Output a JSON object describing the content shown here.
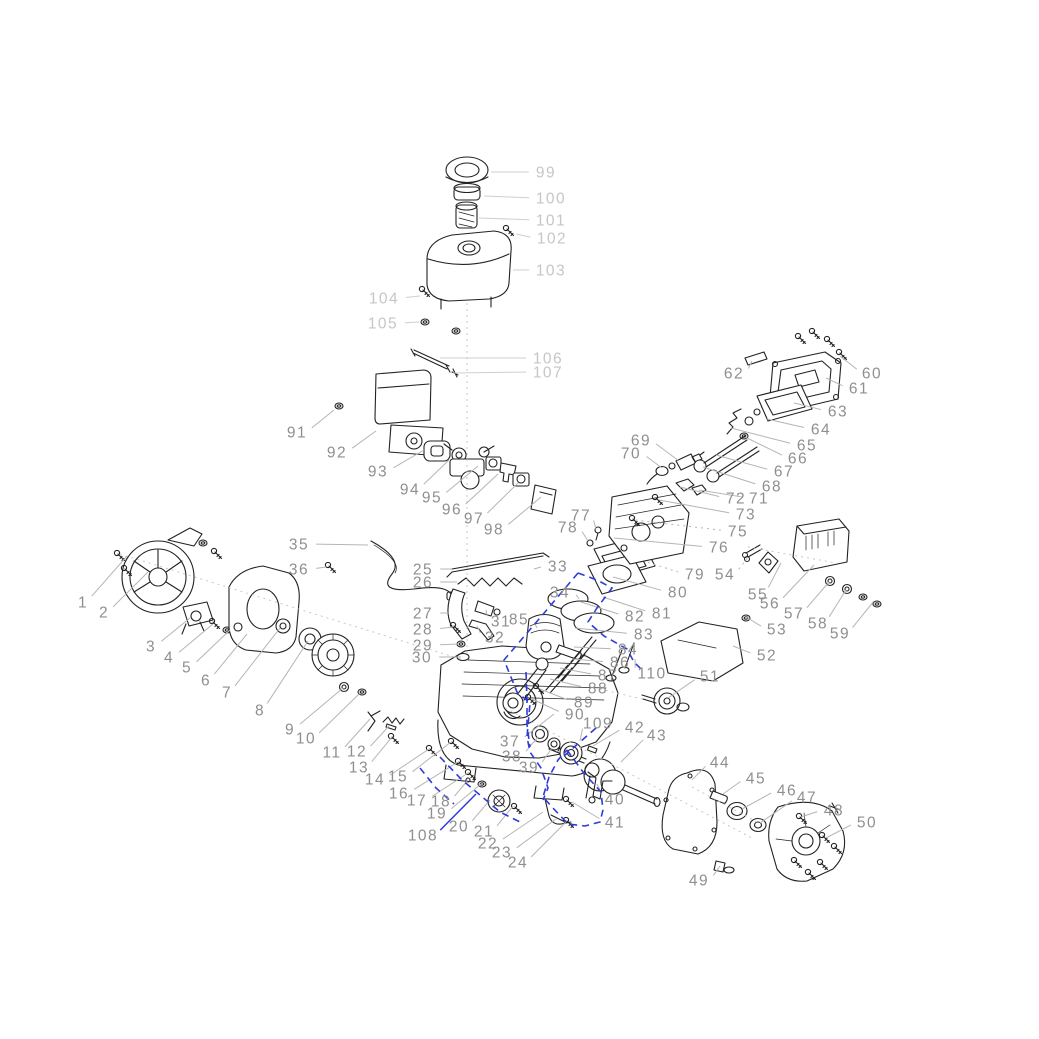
{
  "diagram": {
    "title": "engine-exploded-parts-diagram",
    "background": "#ffffff",
    "colors": {
      "ink": "#222222",
      "label_dark": "#8f8f8f",
      "label_light": "#c6c6c6",
      "leader_dark": "#b5b5b5",
      "leader_light": "#cfcfcf",
      "guide": "#c2c2c2",
      "highlight": "#2e3cd9"
    },
    "font_size": 15.5,
    "labels": [
      {
        "n": "1",
        "x": 83,
        "y": 602,
        "ex": 127,
        "ey": 556
      },
      {
        "n": "2",
        "x": 104,
        "y": 612,
        "ex": 148,
        "ey": 572
      },
      {
        "n": "3",
        "x": 151,
        "y": 646,
        "ex": 190,
        "ey": 618
      },
      {
        "n": "4",
        "x": 169,
        "y": 657,
        "ex": 213,
        "ey": 624
      },
      {
        "n": "5",
        "x": 187,
        "y": 667,
        "ex": 230,
        "ey": 630
      },
      {
        "n": "6",
        "x": 206,
        "y": 680,
        "ex": 247,
        "ey": 634
      },
      {
        "n": "7",
        "x": 227,
        "y": 692,
        "ex": 280,
        "ey": 628
      },
      {
        "n": "8",
        "x": 260,
        "y": 710,
        "ex": 308,
        "ey": 641
      },
      {
        "n": "9",
        "x": 290,
        "y": 729,
        "ex": 343,
        "ey": 688
      },
      {
        "n": "10",
        "x": 306,
        "y": 738,
        "ex": 360,
        "ey": 693
      },
      {
        "n": "11",
        "x": 332,
        "y": 752,
        "ex": 370,
        "ey": 719
      },
      {
        "n": "12",
        "x": 357,
        "y": 751,
        "ex": 389,
        "ey": 726
      },
      {
        "n": "13",
        "x": 359,
        "y": 767,
        "ex": 392,
        "ey": 737
      },
      {
        "n": "14",
        "x": 375,
        "y": 779,
        "ex": 429,
        "ey": 749
      },
      {
        "n": "15",
        "x": 398,
        "y": 776,
        "ex": 451,
        "ey": 742
      },
      {
        "n": "16",
        "x": 399,
        "y": 793,
        "ex": 458,
        "ey": 762
      },
      {
        "n": "17",
        "x": 417,
        "y": 800,
        "ex": 468,
        "ey": 773
      },
      {
        "n": "18",
        "x": 441,
        "y": 801,
        "ex": 468,
        "ey": 780
      },
      {
        "n": "19",
        "x": 437,
        "y": 813,
        "ex": 481,
        "ey": 784
      },
      {
        "n": "20",
        "x": 459,
        "y": 826,
        "ex": 490,
        "ey": 800
      },
      {
        "n": "21",
        "x": 484,
        "y": 831,
        "ex": 513,
        "ey": 806
      },
      {
        "n": "22",
        "x": 488,
        "y": 843,
        "ex": 543,
        "ey": 812
      },
      {
        "n": "23",
        "x": 502,
        "y": 852,
        "ex": 556,
        "ey": 819
      },
      {
        "n": "24",
        "x": 518,
        "y": 862,
        "ex": 566,
        "ey": 822
      },
      {
        "n": "25",
        "x": 423,
        "y": 569,
        "ex": 451,
        "ey": 569
      },
      {
        "n": "26",
        "x": 423,
        "y": 582,
        "ex": 457,
        "ey": 582
      },
      {
        "n": "27",
        "x": 423,
        "y": 613,
        "ex": 449,
        "ey": 613
      },
      {
        "n": "28",
        "x": 423,
        "y": 629,
        "ex": 453,
        "ey": 627
      },
      {
        "n": "29",
        "x": 423,
        "y": 645,
        "ex": 459,
        "ey": 644
      },
      {
        "n": "30",
        "x": 422,
        "y": 657,
        "ex": 461,
        "ey": 657
      },
      {
        "n": "31",
        "x": 501,
        "y": 621,
        "ex": 486,
        "ey": 610
      },
      {
        "n": "32",
        "x": 495,
        "y": 637,
        "ex": 477,
        "ey": 626
      },
      {
        "n": "33",
        "x": 558,
        "y": 566,
        "ex": 534,
        "ey": 569
      },
      {
        "n": "34",
        "x": 560,
        "y": 592,
        "ex": 579,
        "ey": 599
      },
      {
        "n": "35",
        "x": 299,
        "y": 544,
        "ex": 368,
        "ey": 545
      },
      {
        "n": "36",
        "x": 299,
        "y": 569,
        "ex": 326,
        "ey": 567
      },
      {
        "n": "37",
        "x": 510,
        "y": 741,
        "ex": 554,
        "ey": 714
      },
      {
        "n": "38",
        "x": 512,
        "y": 756,
        "ex": 538,
        "ey": 737
      },
      {
        "n": "39",
        "x": 529,
        "y": 767,
        "ex": 552,
        "ey": 748
      },
      {
        "n": "40",
        "x": 615,
        "y": 799,
        "ex": 597,
        "ey": 784
      },
      {
        "n": "41",
        "x": 615,
        "y": 822,
        "ex": 572,
        "ey": 802
      },
      {
        "n": "42",
        "x": 635,
        "y": 727,
        "ex": 593,
        "ey": 746
      },
      {
        "n": "43",
        "x": 657,
        "y": 735,
        "ex": 621,
        "ey": 762
      },
      {
        "n": "44",
        "x": 720,
        "y": 762,
        "ex": 692,
        "ey": 780
      },
      {
        "n": "45",
        "x": 756,
        "y": 778,
        "ex": 723,
        "ey": 794
      },
      {
        "n": "46",
        "x": 787,
        "y": 790,
        "ex": 742,
        "ey": 809
      },
      {
        "n": "47",
        "x": 807,
        "y": 797,
        "ex": 760,
        "ey": 823
      },
      {
        "n": "48",
        "x": 834,
        "y": 810,
        "ex": 801,
        "ey": 817
      },
      {
        "n": "49",
        "x": 699,
        "y": 880,
        "ex": 720,
        "ey": 866
      },
      {
        "n": "50",
        "x": 867,
        "y": 822,
        "ex": 826,
        "ey": 838
      },
      {
        "n": "51",
        "x": 710,
        "y": 676,
        "ex": 668,
        "ey": 698
      },
      {
        "n": "52",
        "x": 767,
        "y": 655,
        "ex": 733,
        "ey": 646
      },
      {
        "n": "53",
        "x": 777,
        "y": 629,
        "ex": 746,
        "ey": 617
      },
      {
        "n": "54",
        "x": 725,
        "y": 574,
        "ex": 749,
        "ey": 556,
        "d": 1
      },
      {
        "n": "55",
        "x": 758,
        "y": 594,
        "ex": 781,
        "ey": 563
      },
      {
        "n": "56",
        "x": 770,
        "y": 603,
        "ex": 814,
        "ey": 565
      },
      {
        "n": "57",
        "x": 794,
        "y": 613,
        "ex": 829,
        "ey": 582
      },
      {
        "n": "58",
        "x": 818,
        "y": 623,
        "ex": 846,
        "ey": 590
      },
      {
        "n": "59",
        "x": 840,
        "y": 633,
        "ex": 874,
        "ey": 601
      },
      {
        "n": "60",
        "x": 872,
        "y": 373,
        "ex": 840,
        "ey": 356
      },
      {
        "n": "61",
        "x": 859,
        "y": 388,
        "ex": 826,
        "ey": 378
      },
      {
        "n": "62",
        "x": 734,
        "y": 373,
        "ex": 752,
        "ey": 361
      },
      {
        "n": "63",
        "x": 838,
        "y": 411,
        "ex": 794,
        "ey": 403
      },
      {
        "n": "64",
        "x": 821,
        "y": 429,
        "ex": 767,
        "ey": 419
      },
      {
        "n": "65",
        "x": 807,
        "y": 445,
        "ex": 731,
        "ey": 428
      },
      {
        "n": "66",
        "x": 798,
        "y": 458,
        "ex": 745,
        "ey": 437
      },
      {
        "n": "67",
        "x": 784,
        "y": 471,
        "ex": 716,
        "ey": 455
      },
      {
        "n": "68",
        "x": 772,
        "y": 486,
        "ex": 703,
        "ey": 467
      },
      {
        "n": "69",
        "x": 641,
        "y": 440,
        "ex": 679,
        "ey": 461
      },
      {
        "n": "70",
        "x": 631,
        "y": 453,
        "ex": 662,
        "ey": 468
      },
      {
        "n": "71",
        "x": 759,
        "y": 498,
        "ex": 699,
        "ey": 490
      },
      {
        "n": "72",
        "x": 736,
        "y": 498,
        "ex": 680,
        "ey": 487
      },
      {
        "n": "73",
        "x": 746,
        "y": 514,
        "ex": 659,
        "ey": 500
      },
      {
        "n": "75",
        "x": 738,
        "y": 531,
        "ex": 635,
        "ey": 520,
        "d": 1
      },
      {
        "n": "76",
        "x": 719,
        "y": 547,
        "ex": 614,
        "ey": 538
      },
      {
        "n": "77",
        "x": 581,
        "y": 515,
        "ex": 596,
        "ey": 529
      },
      {
        "n": "78",
        "x": 568,
        "y": 527,
        "ex": 588,
        "ey": 541
      },
      {
        "n": "79",
        "x": 695,
        "y": 574,
        "ex": 647,
        "ey": 562,
        "d": 1
      },
      {
        "n": "80",
        "x": 678,
        "y": 592,
        "ex": 613,
        "ey": 577
      },
      {
        "n": "81",
        "x": 662,
        "y": 613,
        "ex": 603,
        "ey": 597
      },
      {
        "n": "82",
        "x": 635,
        "y": 616,
        "ex": 581,
        "ey": 602
      },
      {
        "n": "83",
        "x": 644,
        "y": 634,
        "ex": 575,
        "ey": 628
      },
      {
        "n": "84",
        "x": 628,
        "y": 649,
        "ex": 574,
        "ey": 647
      },
      {
        "n": "85",
        "x": 519,
        "y": 619,
        "ex": 537,
        "ey": 628
      },
      {
        "n": "86",
        "x": 620,
        "y": 662,
        "ex": 572,
        "ey": 659
      },
      {
        "n": "87",
        "x": 608,
        "y": 675,
        "ex": 560,
        "ey": 668
      },
      {
        "n": "88",
        "x": 598,
        "y": 688,
        "ex": 550,
        "ey": 679
      },
      {
        "n": "89",
        "x": 584,
        "y": 702,
        "ex": 540,
        "ey": 689
      },
      {
        "n": "90",
        "x": 575,
        "y": 714,
        "ex": 532,
        "ey": 699
      },
      {
        "n": "91",
        "x": 297,
        "y": 432,
        "ex": 334,
        "ey": 410
      },
      {
        "n": "92",
        "x": 337,
        "y": 452,
        "ex": 376,
        "ey": 431
      },
      {
        "n": "93",
        "x": 378,
        "y": 471,
        "ex": 424,
        "ey": 450
      },
      {
        "n": "94",
        "x": 410,
        "y": 489,
        "ex": 449,
        "ey": 460
      },
      {
        "n": "95",
        "x": 432,
        "y": 497,
        "ex": 478,
        "ey": 466
      },
      {
        "n": "96",
        "x": 452,
        "y": 509,
        "ex": 498,
        "ey": 474
      },
      {
        "n": "97",
        "x": 474,
        "y": 518,
        "ex": 518,
        "ey": 483
      },
      {
        "n": "98",
        "x": 494,
        "y": 529,
        "ex": 541,
        "ey": 497
      },
      {
        "n": "99",
        "x": 546,
        "y": 172,
        "ex": 491,
        "ey": 172,
        "s": "l"
      },
      {
        "n": "100",
        "x": 551,
        "y": 198,
        "ex": 484,
        "ey": 196,
        "s": "l"
      },
      {
        "n": "101",
        "x": 551,
        "y": 220,
        "ex": 479,
        "ey": 218,
        "s": "l"
      },
      {
        "n": "102",
        "x": 552,
        "y": 238,
        "ex": 516,
        "ey": 234,
        "s": "l"
      },
      {
        "n": "103",
        "x": 551,
        "y": 270,
        "ex": 513,
        "ey": 270,
        "s": "l"
      },
      {
        "n": "104",
        "x": 384,
        "y": 298,
        "ex": 420,
        "ey": 296,
        "s": "l"
      },
      {
        "n": "105",
        "x": 383,
        "y": 323,
        "ex": 419,
        "ey": 322,
        "s": "l"
      },
      {
        "n": "106",
        "x": 548,
        "y": 358,
        "ex": 440,
        "ey": 358,
        "s": "l"
      },
      {
        "n": "107",
        "x": 548,
        "y": 372,
        "ex": 453,
        "ey": 373,
        "s": "l"
      },
      {
        "n": "108",
        "x": 423,
        "y": 835,
        "ex": 476,
        "ey": 794,
        "b": 1
      },
      {
        "n": "109",
        "x": 598,
        "y": 723,
        "ex": 580,
        "ey": 741
      },
      {
        "n": "110",
        "x": 652,
        "y": 673,
        "ex": 635,
        "ey": 659
      }
    ],
    "highlights": [
      "578,573 545,612 504,660 517,692 530,703 527,737 530,752 541,768 548,788 543,800",
      "578,573 597,580 612,588 597,608 588,622 604,636 627,649 634,662 643,671",
      "567,750 583,772 601,792 603,810 600,822 585,826 568,824 552,807 543,797 549,777 558,760 567,750",
      "440,757 462,780 480,795 500,812 522,823",
      "420,768 436,788 454,804",
      "526,672 527,700 527,725 530,747",
      "596,728 580,742 564,756"
    ],
    "guides": [
      [
        467,
        303,
        467,
        656
      ],
      [
        120,
        554,
        464,
        660
      ],
      [
        748,
        547,
        836,
        563
      ],
      [
        600,
        689,
        646,
        700
      ],
      [
        505,
        708,
        752,
        838
      ],
      [
        692,
        787,
        757,
        822
      ]
    ]
  }
}
